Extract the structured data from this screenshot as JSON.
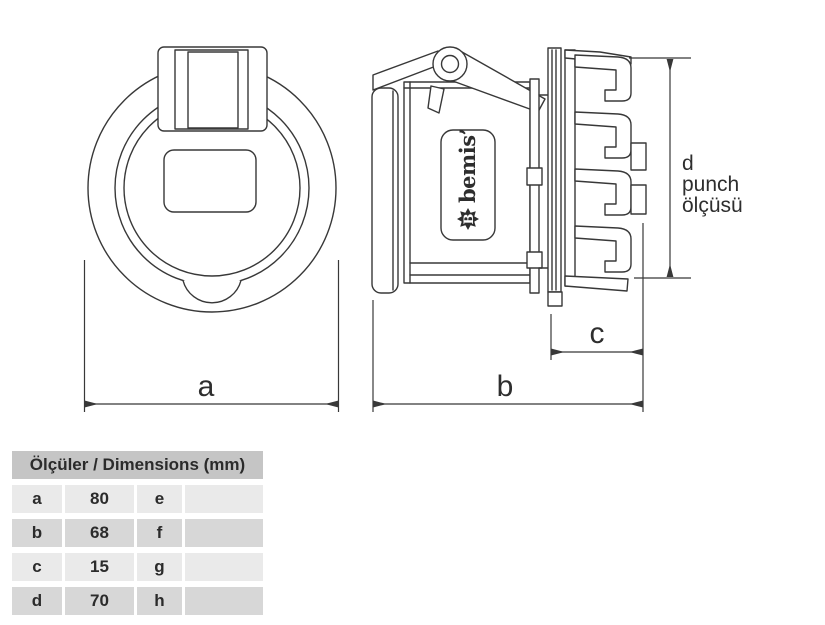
{
  "drawing": {
    "brand": {
      "badge_letter": "B",
      "name": "bemis’"
    },
    "dimension_labels": {
      "a": "a",
      "b": "b",
      "c": "c",
      "d_line1": "d",
      "d_line2": "punch",
      "d_line3": "ölçüsü"
    }
  },
  "table": {
    "header": "Ölçüler / Dimensions (mm)",
    "rows": [
      {
        "k1": "a",
        "v1": "80",
        "k2": "e",
        "v2": ""
      },
      {
        "k1": "b",
        "v1": "68",
        "k2": "f",
        "v2": ""
      },
      {
        "k1": "c",
        "v1": "15",
        "k2": "g",
        "v2": ""
      },
      {
        "k1": "d",
        "v1": "70",
        "k2": "h",
        "v2": ""
      }
    ]
  },
  "colors": {
    "background": "#ffffff",
    "line": "#383838",
    "table_header_bg": "#c5c5c5",
    "row_light": "#eaeaea",
    "row_dark": "#d7d7d7",
    "text": "#2b2b2b"
  }
}
